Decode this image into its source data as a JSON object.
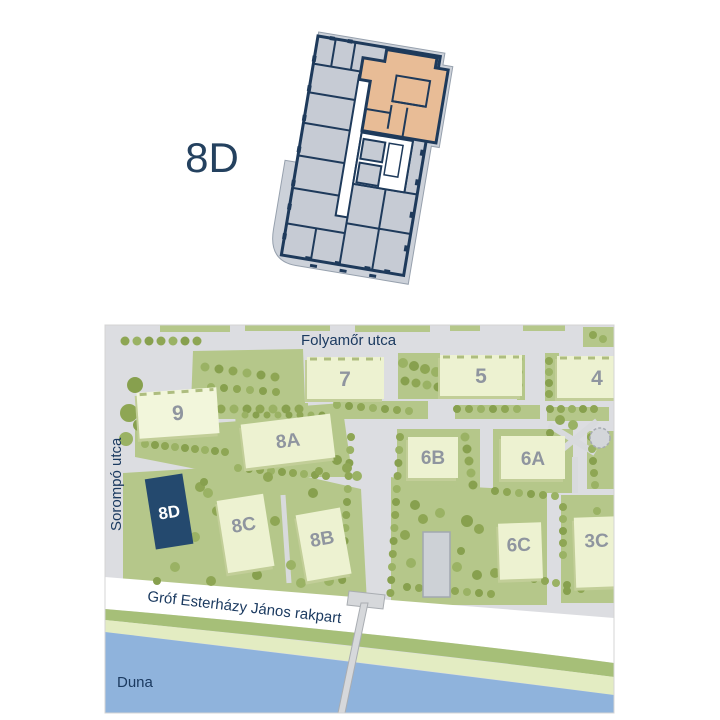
{
  "floorplan": {
    "title": "8D",
    "wall_color": "#1e3a5b",
    "unit_fill": "#c6cbd4",
    "highlight_fill": "#e8bc96"
  },
  "map": {
    "streets": {
      "top": "Folyamőr utca",
      "left": "Sorompó utca",
      "embankment": "Gróf Esterházy János rakpart",
      "river": "Duna"
    },
    "buildings": [
      {
        "label": "9"
      },
      {
        "label": "7"
      },
      {
        "label": "5"
      },
      {
        "label": "4"
      },
      {
        "label": "8A"
      },
      {
        "label": "6B"
      },
      {
        "label": "6A"
      },
      {
        "label": "8D",
        "highlighted": true
      },
      {
        "label": "8C"
      },
      {
        "label": "8B"
      },
      {
        "label": "6C"
      },
      {
        "label": "3C"
      }
    ],
    "colors": {
      "highlight": "#24496e",
      "building": "#edf2d1",
      "building_shadow": "#c2ce98",
      "green": "#b5c78a",
      "tree": "#8ea654",
      "street": "#dcdde1",
      "river": "#8fb3dc",
      "bank_green": "#a6bf78",
      "bank_pale": "#e3ecc2",
      "street_label": "#1b3a60",
      "building_number": "#8f959f"
    }
  }
}
